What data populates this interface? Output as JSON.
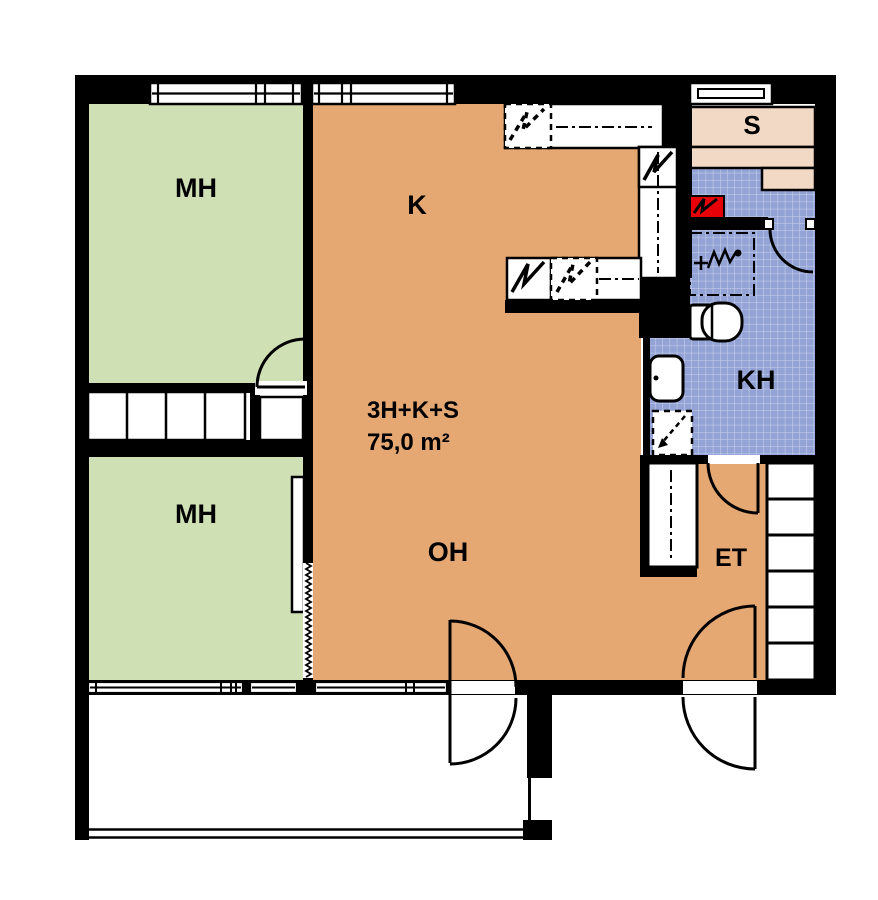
{
  "apartment": {
    "type": "3H+K+S",
    "area": "75,0 m²"
  },
  "rooms": {
    "bedroom_top": {
      "label": "MH"
    },
    "bedroom_bottom": {
      "label": "MH"
    },
    "kitchen": {
      "label": "K"
    },
    "living_room": {
      "label": "OH"
    },
    "hall": {
      "label": "ET"
    },
    "bathroom": {
      "label": "KH"
    },
    "sauna": {
      "label": "S"
    }
  },
  "colors": {
    "wall": "#000000",
    "bedroom_green": "#cfe0b5",
    "floor_orange": "#e5a873",
    "sauna_bench_pink": "#f2d9c5",
    "tile_blue": "#93a3d6",
    "tile_grid": "#cdd3ea",
    "stove_red": "#e60008",
    "paper_white": "#ffffff"
  }
}
